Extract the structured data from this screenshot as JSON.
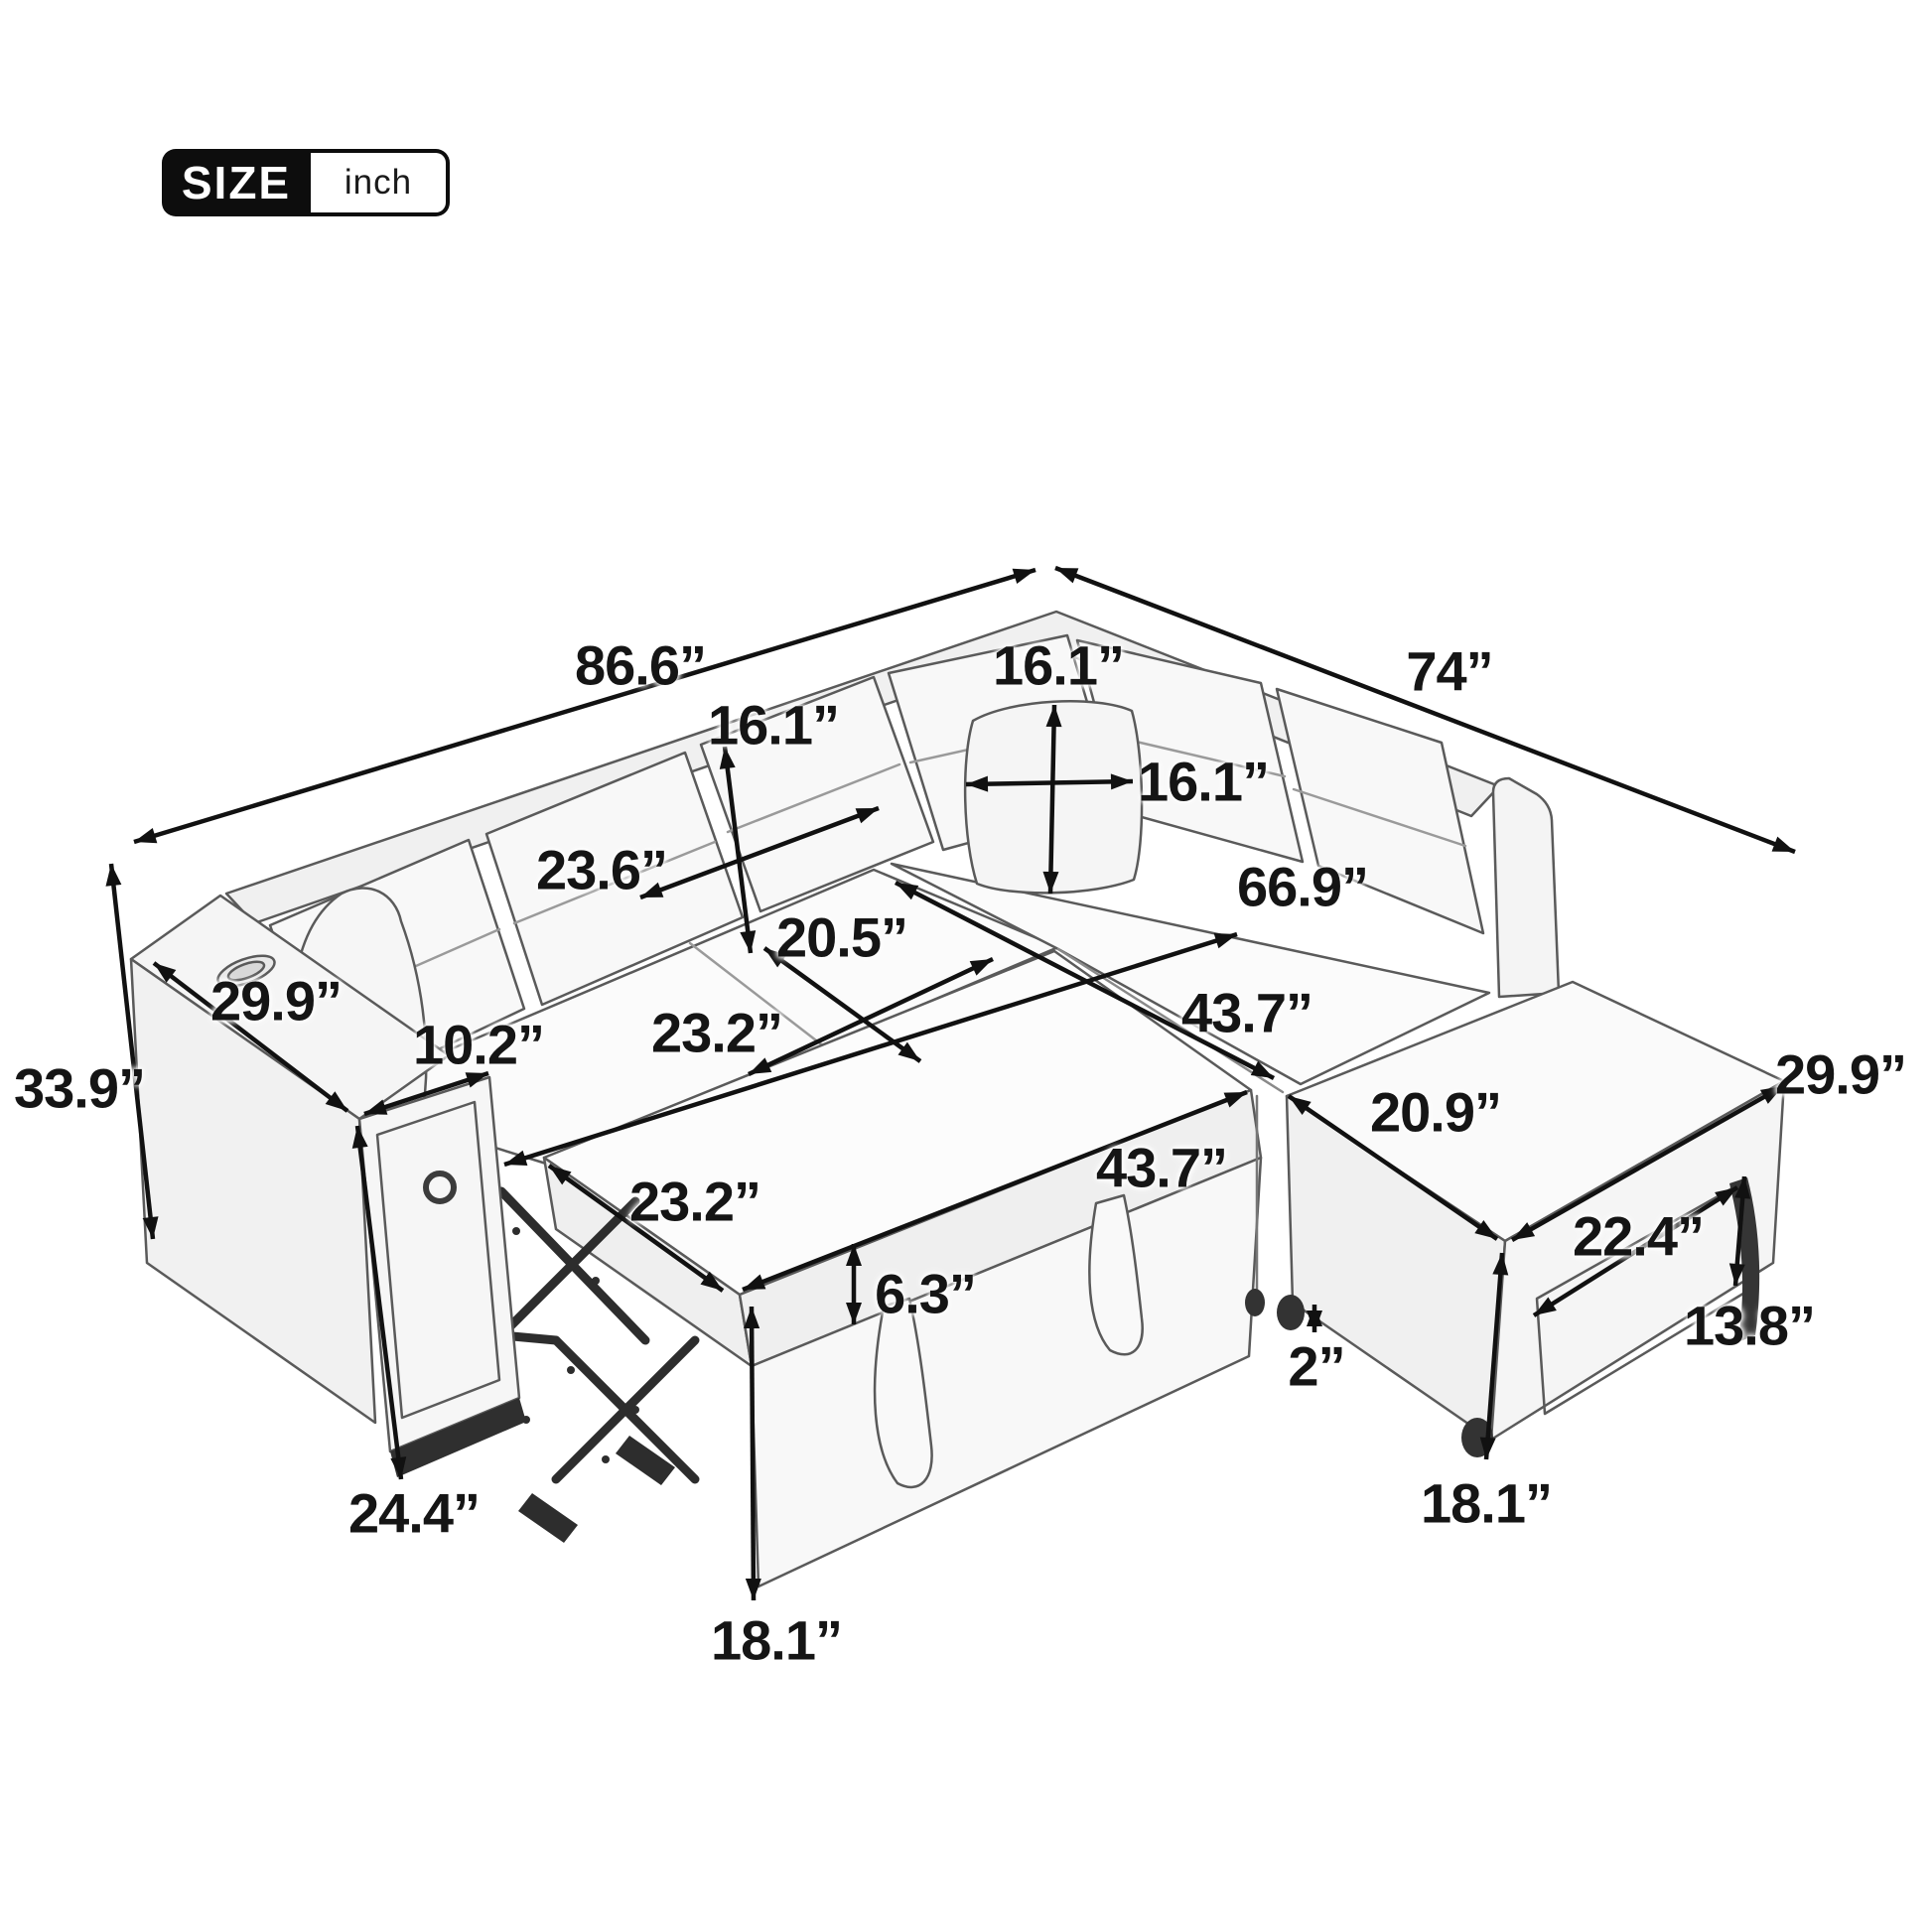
{
  "badge": {
    "size": "SIZE",
    "unit": "inch"
  },
  "dims": [
    {
      "name": "back-width",
      "text": "86.6”"
    },
    {
      "name": "right-side-width",
      "text": "74”"
    },
    {
      "name": "back-cushion-height",
      "text": "16.1”"
    },
    {
      "name": "pillow-height",
      "text": "16.1”"
    },
    {
      "name": "pillow-width",
      "text": "16.1”"
    },
    {
      "name": "back-cushion-width",
      "text": "23.6”"
    },
    {
      "name": "sleeper-diagonal-length",
      "text": "66.9”"
    },
    {
      "name": "seat-depth",
      "text": "20.5”"
    },
    {
      "name": "seat-cushion-width",
      "text": "23.2”"
    },
    {
      "name": "seat-section-length",
      "text": "43.7”"
    },
    {
      "name": "armrest-top-length",
      "text": "29.9”"
    },
    {
      "name": "armrest-width",
      "text": "10.2”"
    },
    {
      "name": "overall-height",
      "text": "33.9”"
    },
    {
      "name": "ottoman-top-width",
      "text": "29.9”"
    },
    {
      "name": "ottoman-top-depth",
      "text": "20.9”"
    },
    {
      "name": "pullout-bed-length",
      "text": "43.7”"
    },
    {
      "name": "pullout-bed-width",
      "text": "23.2”"
    },
    {
      "name": "side-drawer-width",
      "text": "22.4”"
    },
    {
      "name": "mattress-thickness",
      "text": "6.3”"
    },
    {
      "name": "side-drawer-height",
      "text": "13.8”"
    },
    {
      "name": "leg-height",
      "text": "2”"
    },
    {
      "name": "armrest-front-height",
      "text": "24.4”"
    },
    {
      "name": "ottoman-height",
      "text": "18.1”"
    },
    {
      "name": "bed-height",
      "text": "18.1”"
    }
  ]
}
